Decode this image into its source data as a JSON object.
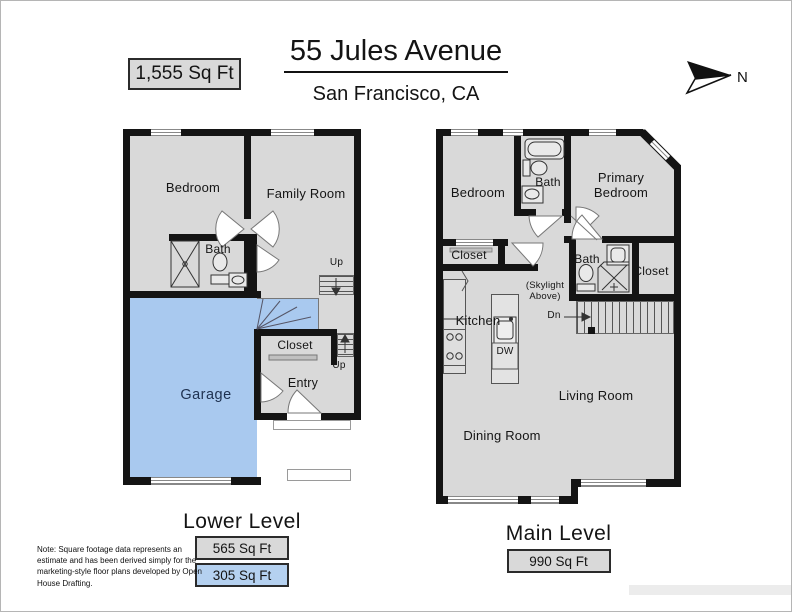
{
  "header": {
    "area_badge": "1,555 Sq Ft",
    "title": "55 Jules Avenue",
    "subtitle": "San Francisco, CA",
    "north_label": "N"
  },
  "lower": {
    "title": "Lower Level",
    "badge_main": "565 Sq Ft",
    "badge_garage": "305 Sq Ft",
    "rooms": {
      "bedroom": "Bedroom",
      "family_room": "Family Room",
      "bath": "Bath",
      "up_upper": "Up",
      "up_lower": "Up",
      "closet": "Closet",
      "entry": "Entry",
      "garage": "Garage"
    }
  },
  "main": {
    "title": "Main Level",
    "badge": "990 Sq Ft",
    "rooms": {
      "bedroom": "Bedroom",
      "hall_bath": "Bath",
      "primary_bedroom": "Primary Bedroom",
      "closet": "Closet",
      "primary_bath": "Bath",
      "primary_closet": "Closet",
      "skylight": "(Skylight Above)",
      "kitchen": "Kitchen",
      "dishwasher": "DW",
      "down": "Dn",
      "living_room": "Living Room",
      "dining_room": "Dining Room"
    }
  },
  "footnote": "Note: Square footage data represents an estimate and has been derived simply for the marketing-style floor plans developed by Open House Drafting.",
  "colors": {
    "wall": "#141414",
    "floor": "#d9d9d9",
    "garage": "#a9c9ef",
    "garage_text": "#1e3150",
    "badge_gray": "#d9d9d9",
    "badge_blue": "#b5d1f0"
  }
}
